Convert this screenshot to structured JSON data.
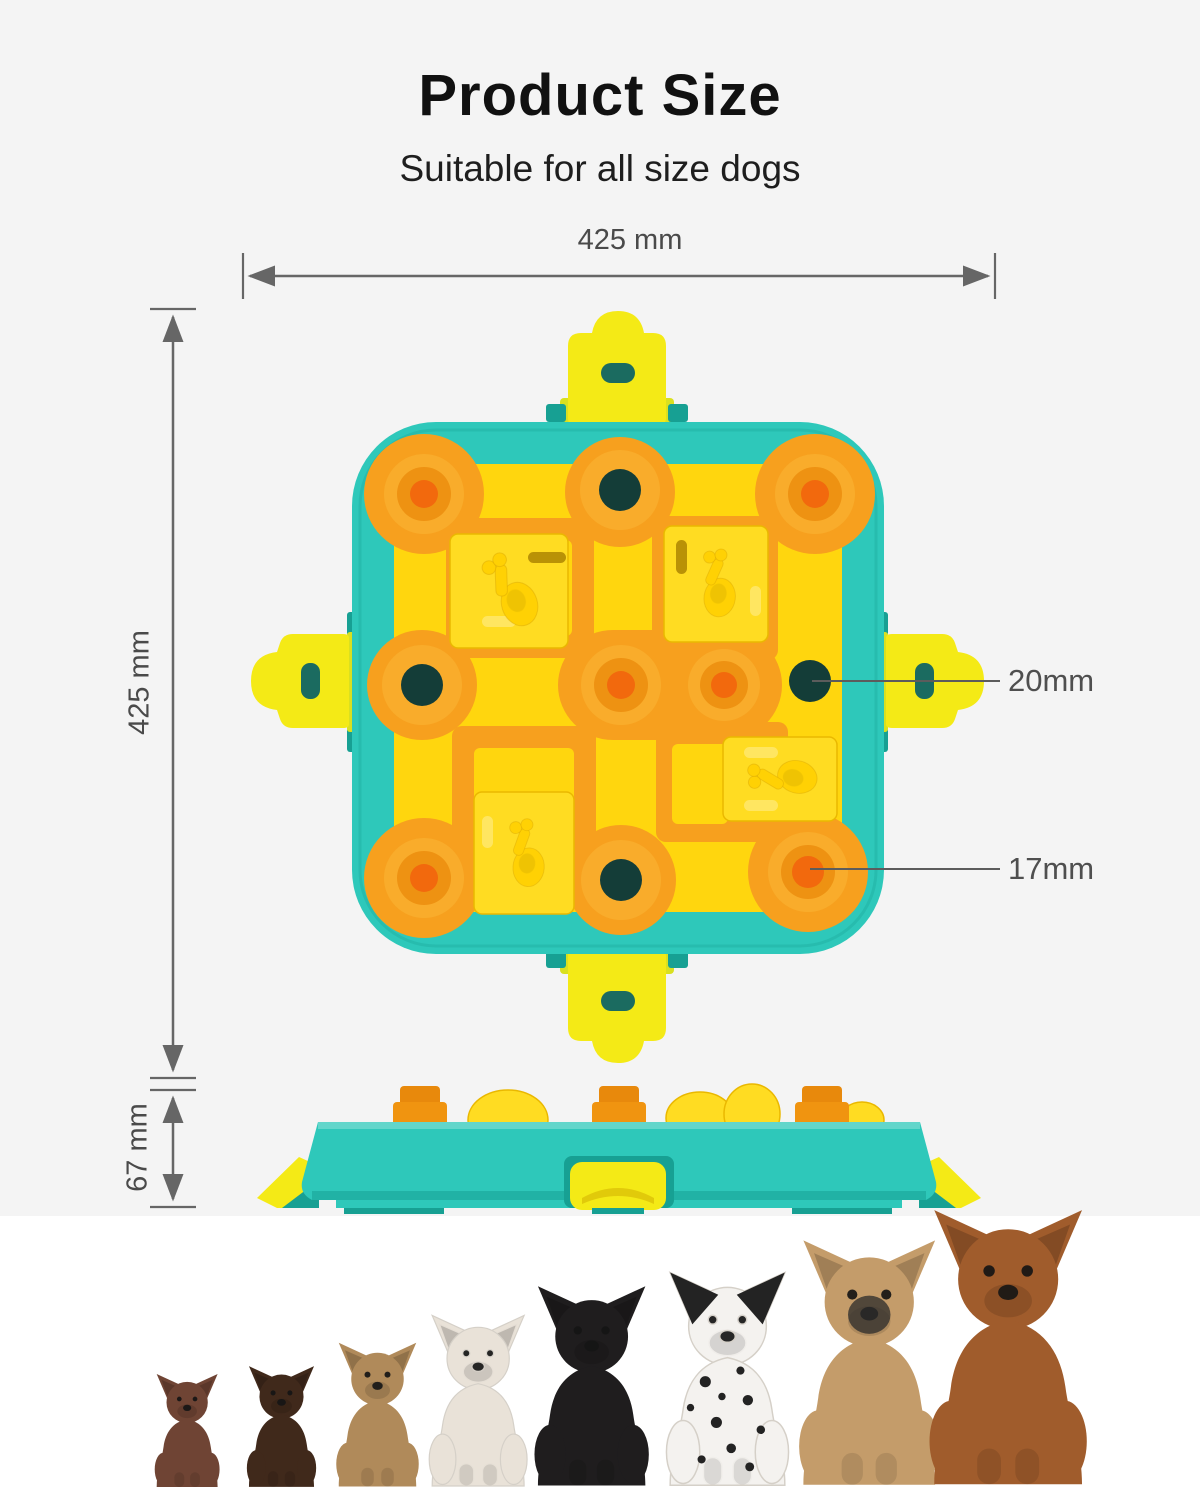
{
  "page": {
    "title": "Product Size",
    "subtitle": "Suitable for all size dogs"
  },
  "dimensions": {
    "width": {
      "label": "425 mm",
      "orientation": "horizontal"
    },
    "height": {
      "label": "425 mm",
      "orientation": "vertical"
    },
    "depth": {
      "label": "67 mm",
      "orientation": "vertical"
    }
  },
  "callouts": {
    "feeding_hole": {
      "label": "20mm",
      "target": "round-hole-on-board"
    },
    "treat_well": {
      "label": "17mm",
      "target": "corner-treat-well"
    }
  },
  "product": {
    "kind": "dog puzzle slow-feeder toy",
    "views": [
      "top view",
      "side view"
    ],
    "slider_icon": "drumstick-icon",
    "slider_count": 4
  },
  "dogs": [
    {
      "breed": "chihuahua",
      "fur": "#6f4434"
    },
    {
      "breed": "dachshund",
      "fur": "#40291b"
    },
    {
      "breed": "shetland-sheepdog",
      "fur": "#b08a5a"
    },
    {
      "breed": "french-bulldog",
      "fur": "#e9e2d8"
    },
    {
      "breed": "labrador",
      "fur": "#1f1d1e"
    },
    {
      "breed": "dalmatian",
      "fur": "#f4f2ef"
    },
    {
      "breed": "malinois",
      "fur": "#c49c6a"
    },
    {
      "breed": "rhodesian-ridgeback",
      "fur": "#a05c2c"
    }
  ],
  "colors": {
    "background": "#f4f4f4",
    "dog_strip_background": "#ffffff",
    "frame_teal": "#2ec8ba",
    "frame_teal_dark": "#17a093",
    "board_yellow": "#ffd60e",
    "slider_yellow": "#ffdc22",
    "clip_yellow": "#f4ea16",
    "clip_lime": "#d9e020",
    "track_orange": "#f7a01e",
    "well_orange": "#f9ac2b",
    "well_ring_orange": "#ee9212",
    "well_center_orange": "#f2690d",
    "hole_dark": "#143d38",
    "knob_orange": "#f09410",
    "drumstick_yellow": "#ffd104",
    "dimension_gray": "#666666",
    "text_dark": "#111111",
    "label_gray": "#4a4a4a"
  }
}
